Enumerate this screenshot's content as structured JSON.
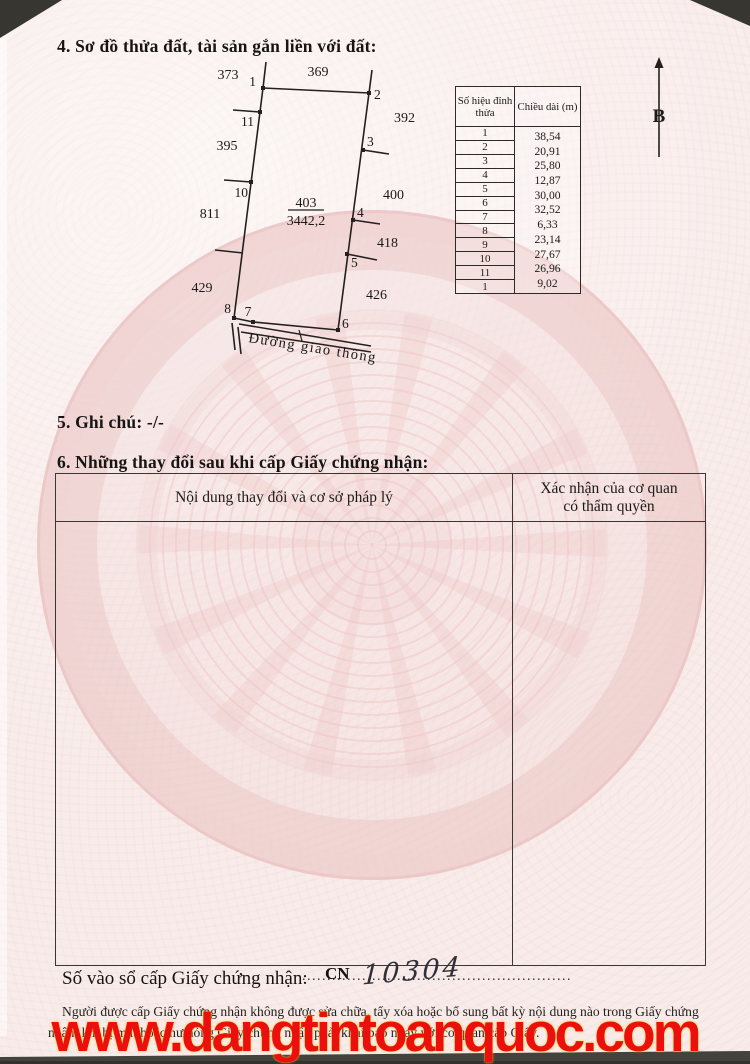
{
  "page": {
    "section4_title": "4. Sơ đồ thửa đất, tài sản gắn liền với đất:",
    "section5_text": "5. Ghi chú: -/-",
    "section6_title": "6. Những thay đổi sau khi cấp Giấy chứng nhận:",
    "registry": {
      "label": "Số vào sổ cấp Giấy chứng nhận:",
      "code": "CN",
      "number": "10304",
      "dots": "..................................................................."
    },
    "footer_note_line1": "Người được cấp Giấy chứng nhận không được sửa chữa, tẩy xóa hoặc bổ sung bất kỳ nội dung nào trong",
    "footer_note_line2": "Giấy chứng nhận; khi bị mất hoặc hư hỏng Giấy chứng nhận phải khai báo ngay với cơ quan cấp Giấy.",
    "watermark_text": "www.dangtintoanquoc.com",
    "colors": {
      "paper": "#f8ecea",
      "emblem_pink": "#f0d2d1",
      "watermark_red": "#ec0f0f",
      "ink": "#1c1a18"
    }
  },
  "diagram": {
    "north_label": "B",
    "road_label": "Đường giao thông",
    "parcel_number": "403",
    "parcel_area": "3442,2",
    "vertices": {
      "v1": "1",
      "v2": "2",
      "v3": "3",
      "v4": "4",
      "v5": "5",
      "v6": "6",
      "v7": "7",
      "v8": "8",
      "v10": "10",
      "v11": "11"
    },
    "parcels": {
      "p373": "373",
      "p369": "369",
      "p392": "392",
      "p395": "395",
      "p400": "400",
      "p811": "811",
      "p418": "418",
      "p429": "429",
      "p426": "426"
    }
  },
  "vertex_table": {
    "col1_header": "Số hiệu đỉnh thửa",
    "col2_header": "Chiều dài (m)",
    "vertices": [
      "1",
      "2",
      "3",
      "4",
      "5",
      "6",
      "7",
      "8",
      "9",
      "10",
      "11",
      "1"
    ],
    "lengths": [
      "38,54",
      "20,91",
      "25,80",
      "12,87",
      "30,00",
      "32,52",
      "6,33",
      "23,14",
      "27,67",
      "26,96",
      "9,02"
    ]
  },
  "changes_table": {
    "col1_header": "Nội dung thay đổi và cơ sở pháp lý",
    "col2_header_line1": "Xác nhận của cơ quan",
    "col2_header_line2": "có thẩm quyền"
  }
}
